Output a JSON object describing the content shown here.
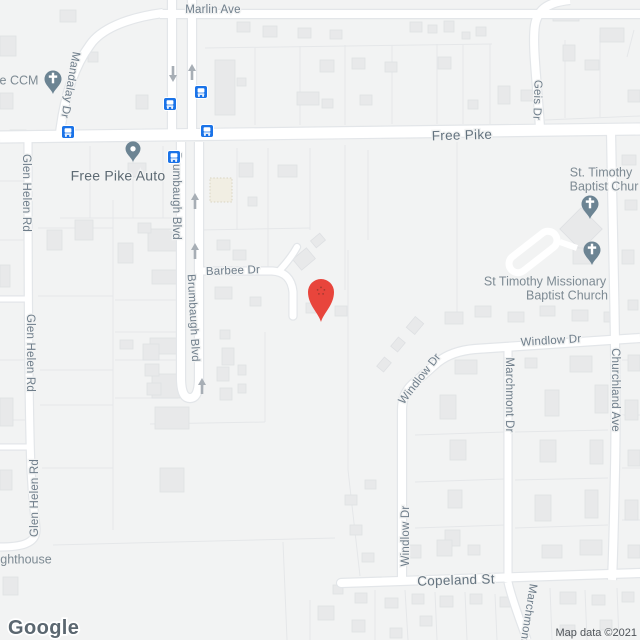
{
  "map": {
    "watermark": {
      "logo": "Google",
      "attribution": "Map data ©2021"
    },
    "marker": {
      "name": "selected-location-marker",
      "x": 321,
      "y": 292,
      "color": "#e8453c",
      "dot_color": "#a33a30"
    },
    "colors": {
      "background": "#f2f3f3",
      "road_fill": "#ffffff",
      "road_casing": "#e3e6e9",
      "building_fill": "#e8e9ea",
      "building_stroke": "#dee0e3",
      "parcel_line": "#e5e7e9",
      "bus_blue": "#1a73e8",
      "pin_slate": "#6c8493",
      "marker_red": "#e8453c",
      "road_label": "#6e7d8a",
      "poi_label": "#7d8a93"
    },
    "labels": [
      {
        "id": "marlin-ave",
        "text": "Marlin Ave",
        "x": 213,
        "y": 10,
        "rot": 0,
        "cls": "lbl-road"
      },
      {
        "id": "mandalay-dr",
        "text": "Mandalay Dr",
        "x": 70,
        "y": 85,
        "rot": 100,
        "cls": "lbl-road"
      },
      {
        "id": "free-pike",
        "text": "Free Pike",
        "x": 462,
        "y": 136,
        "rot": -1.5,
        "cls": "lbl-road-lg"
      },
      {
        "id": "geis-dr",
        "text": "Geis Dr",
        "x": 537,
        "y": 100,
        "rot": 92,
        "cls": "lbl-road"
      },
      {
        "id": "glen-helen-rd-1",
        "text": "Glen Helen Rd",
        "x": 26,
        "y": 193,
        "rot": 90,
        "cls": "lbl-road"
      },
      {
        "id": "glen-helen-rd-2",
        "text": "Glen Helen Rd",
        "x": 30,
        "y": 353,
        "rot": 90,
        "cls": "lbl-road"
      },
      {
        "id": "glen-helen-rd-3",
        "text": "Glen Helen Rd",
        "x": 35,
        "y": 498,
        "rot": -90,
        "cls": "lbl-road"
      },
      {
        "id": "brumbaugh-blvd-1",
        "text": "Brumbaugh Blvd",
        "x": 176,
        "y": 196,
        "rot": 90,
        "cls": "lbl-road"
      },
      {
        "id": "brumbaugh-blvd-2",
        "text": "Brumbaugh Blvd",
        "x": 193,
        "y": 318,
        "rot": 87,
        "cls": "lbl-road"
      },
      {
        "id": "barbee-dr",
        "text": "Barbee Dr",
        "x": 233,
        "y": 271,
        "rot": -2,
        "cls": "lbl-road"
      },
      {
        "id": "windlow-dr-h",
        "text": "Windlow Dr",
        "x": 551,
        "y": 341,
        "rot": -3.5,
        "cls": "lbl-road"
      },
      {
        "id": "windlow-dr-diag",
        "text": "Windlow Dr",
        "x": 420,
        "y": 379,
        "rot": -52,
        "cls": "lbl-road"
      },
      {
        "id": "windlow-dr-v",
        "text": "Windlow Dr",
        "x": 406,
        "y": 536,
        "rot": -90,
        "cls": "lbl-road"
      },
      {
        "id": "marchmont-dr",
        "text": "Marchmont Dr",
        "x": 509,
        "y": 395,
        "rot": 90,
        "cls": "lbl-road"
      },
      {
        "id": "churchland-ave",
        "text": "Churchland Ave",
        "x": 615,
        "y": 390,
        "rot": 90,
        "cls": "lbl-road"
      },
      {
        "id": "copeland-st",
        "text": "Copeland St",
        "x": 456,
        "y": 581,
        "rot": -1.8,
        "cls": "lbl-road-lg"
      },
      {
        "id": "marchmont-dr-2",
        "text": "Marchmont Dr",
        "x": 527,
        "y": 621,
        "rot": 99,
        "cls": "lbl-road"
      },
      {
        "id": "ccm-poi",
        "text": "e CCM",
        "x": 19,
        "y": 81,
        "rot": 0,
        "cls": "lbl-poi"
      },
      {
        "id": "free-pike-auto-poi",
        "text": "Free Pike Auto",
        "x": 118,
        "y": 177,
        "rot": 0,
        "cls": "lbl-poi-dark"
      },
      {
        "id": "st-timothy-line1",
        "text": "St. Timothy",
        "x": 601,
        "y": 173,
        "rot": 0,
        "cls": "lbl-poi"
      },
      {
        "id": "st-timothy-line2",
        "text": "Baptist Chur",
        "x": 604,
        "y": 187,
        "rot": 0,
        "cls": "lbl-poi"
      },
      {
        "id": "st-timothy-missionary-line1",
        "text": "St Timothy Missionary",
        "x": 545,
        "y": 282,
        "rot": 0,
        "cls": "lbl-poi"
      },
      {
        "id": "st-timothy-missionary-line2",
        "text": "Baptist Church",
        "x": 567,
        "y": 296,
        "rot": 0,
        "cls": "lbl-poi"
      },
      {
        "id": "lighthouse-poi",
        "text": "ghthouse",
        "x": 26,
        "y": 560,
        "rot": 0,
        "cls": "lbl-poi"
      }
    ],
    "bus_stops": [
      {
        "x": 68,
        "y": 132
      },
      {
        "x": 170,
        "y": 104
      },
      {
        "x": 201,
        "y": 92
      },
      {
        "x": 207,
        "y": 131
      },
      {
        "x": 174,
        "y": 157
      }
    ],
    "church_pins": [
      {
        "x": 53,
        "y": 79
      },
      {
        "x": 590,
        "y": 204
      },
      {
        "x": 592,
        "y": 250
      }
    ],
    "poi_pins": [
      {
        "x": 133,
        "y": 149
      }
    ],
    "oneway_arrows": [
      {
        "x": 173,
        "y": 73,
        "dir": "down"
      },
      {
        "x": 192,
        "y": 73,
        "dir": "up"
      },
      {
        "x": 195,
        "y": 202,
        "dir": "up"
      },
      {
        "x": 195,
        "y": 252,
        "dir": "up"
      },
      {
        "x": 202,
        "y": 387,
        "dir": "up"
      }
    ]
  }
}
